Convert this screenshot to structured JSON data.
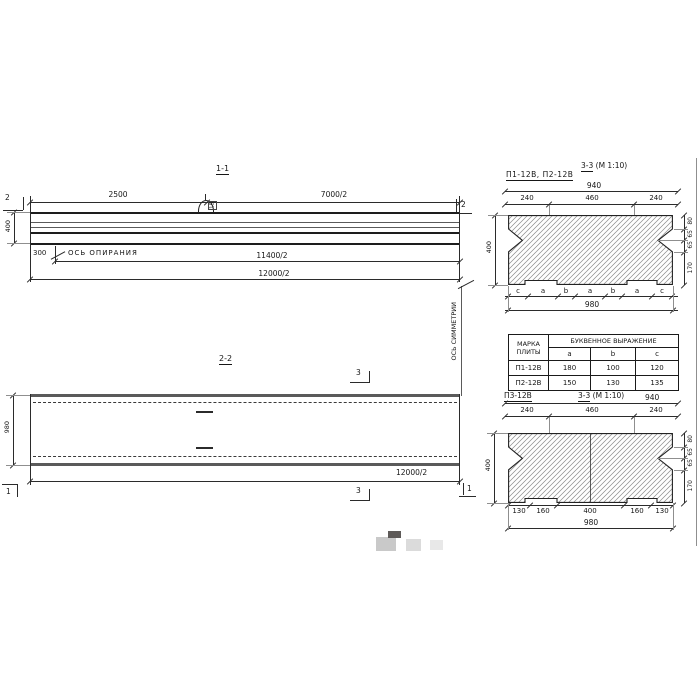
{
  "sec11": {
    "title": "1-1",
    "dim_top_left": "2500",
    "dim_top_right": "7000/2",
    "cut_label": "2",
    "height_dim": "400",
    "offset_dim": "300",
    "support_axis_label": "ОСЬ ОПИРАНИЯ",
    "dim_11400": "11400/2",
    "dim_12000": "12000/2",
    "loop_dim": "15"
  },
  "sec22": {
    "title": "2-2",
    "width_dim": "980",
    "dim_12000": "12000/2",
    "cut3_label": "3",
    "cut1_label": "1",
    "symmetry_axis_label": "ОСЬ СИММЕТРИИ"
  },
  "sec33top": {
    "marks_label": "П1-12В, П2-12В",
    "title_num": "3-3",
    "title_scale": "(М 1:10)",
    "dim_940": "940",
    "dims_top": [
      "240",
      "460",
      "240"
    ],
    "height_dim": "400",
    "dims_right": [
      "80",
      "65",
      "65",
      "170"
    ],
    "letter_row": [
      "c",
      "a",
      "b",
      "a",
      "b",
      "a",
      "c"
    ],
    "dim_980": "980"
  },
  "sec33bot": {
    "mark_label": "П3-12В",
    "title_num": "3-3",
    "title_scale": "(М 1:10)",
    "dim_940": "940",
    "dims_top": [
      "240",
      "460",
      "240"
    ],
    "height_dim": "400",
    "dims_right": [
      "80",
      "65",
      "65",
      "170"
    ],
    "dims_bottom": [
      "130",
      "160",
      "400",
      "160",
      "130"
    ],
    "dim_980": "980"
  },
  "table": {
    "col_mark_header": "МАРКА ПЛИТЫ",
    "col_expr_header": "БУКВЕННОЕ  ВЫРАЖЕНИЕ",
    "sub_headers": [
      "a",
      "b",
      "c"
    ],
    "rows": [
      {
        "mark": "П1-12В",
        "a": "180",
        "b": "100",
        "c": "120"
      },
      {
        "mark": "П2-12В",
        "a": "150",
        "b": "130",
        "c": "135"
      }
    ]
  }
}
